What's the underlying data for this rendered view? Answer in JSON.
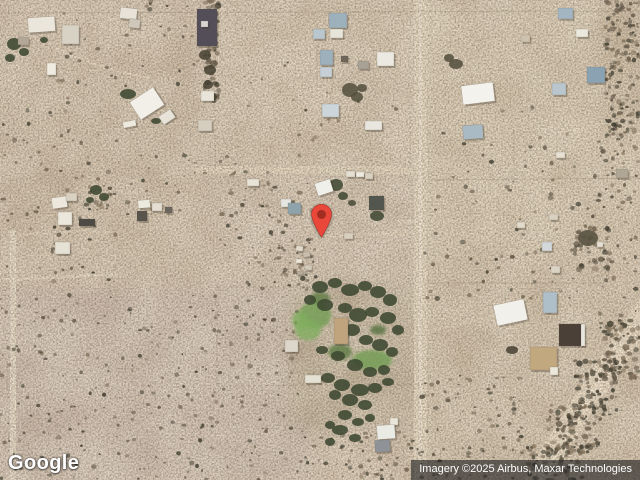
{
  "overlay": {
    "logo_text": "Google",
    "attribution_text": "Imagery ©2025 Airbus, Maxar Technologies"
  },
  "map": {
    "base_color": "#dccbb6",
    "fence_color": "#6b5b45",
    "shadow_color": "#3a3226",
    "building_stroke": "rgba(95,84,66,0.35)",
    "tree_color": "#3d4831",
    "shrub_colors": [
      "#6f6150",
      "#5a5040",
      "#474234",
      "#7d6d57",
      "#3c3a2e"
    ],
    "marker": {
      "x": 321,
      "y": 239,
      "body_color": "#e8473a",
      "dot_color": "#a32c20",
      "outline_color": "rgba(125,28,18,0.55)"
    },
    "patches": [
      {
        "x": 420,
        "y": 0,
        "w": 220,
        "h": 260,
        "fill": "#e5d7bf",
        "op": 0.9
      },
      {
        "x": 215,
        "y": 0,
        "w": 205,
        "h": 168,
        "fill": "#e3d3bd",
        "op": 0.85
      },
      {
        "x": 0,
        "y": 0,
        "w": 212,
        "h": 95,
        "fill": "#dfcfba",
        "op": 0.7
      },
      {
        "x": 25,
        "y": 95,
        "w": 200,
        "h": 190,
        "fill": "#d9c8b2",
        "op": 0.7
      },
      {
        "x": 0,
        "y": 290,
        "w": 310,
        "h": 190,
        "fill": "#d8c8bc",
        "op": 0.9
      },
      {
        "x": 215,
        "y": 168,
        "w": 205,
        "h": 115,
        "fill": "#e1d1be",
        "op": 0.85
      },
      {
        "x": 285,
        "y": 282,
        "w": 135,
        "h": 145,
        "fill": "#c9baa2",
        "op": 0.9
      },
      {
        "x": 420,
        "y": 262,
        "w": 220,
        "h": 218,
        "fill": "#ddcdb6",
        "op": 0.75
      },
      {
        "x": 602,
        "y": 0,
        "w": 38,
        "h": 140,
        "fill": "#cdbba1",
        "op": 0.7
      },
      {
        "x": 455,
        "y": 285,
        "w": 145,
        "h": 55,
        "fill": "#e3d5be",
        "op": 0.6
      }
    ],
    "roads": [
      {
        "kind": "rect",
        "x": 414,
        "y": 0,
        "w": 13,
        "h": 480,
        "fill": "#e8dcc5",
        "op": 1
      },
      {
        "kind": "rect",
        "x": 419,
        "y": 0,
        "w": 3,
        "h": 480,
        "fill": "#f1e8d4",
        "op": 0.8
      },
      {
        "kind": "rect",
        "x": 429,
        "y": 0,
        "w": 3,
        "h": 480,
        "fill": "#e2d5bd",
        "op": 0.5
      },
      {
        "kind": "rect",
        "x": 10,
        "y": 230,
        "w": 6,
        "h": 250,
        "fill": "#eadfca",
        "op": 0.9
      },
      {
        "kind": "rect",
        "x": 195,
        "y": 166,
        "w": 223,
        "h": 8,
        "fill": "#e7dac3",
        "op": 0.85
      },
      {
        "kind": "line",
        "x1": 0,
        "y1": 280,
        "x2": 120,
        "y2": 274,
        "w": 3,
        "fill": "#eadfc9",
        "op": 0.7
      },
      {
        "kind": "line",
        "x1": 318,
        "y1": 236,
        "x2": 414,
        "y2": 233,
        "w": 3,
        "fill": "#e9dcc4",
        "op": 0.6
      },
      {
        "kind": "line",
        "x1": 398,
        "y1": 222,
        "x2": 416,
        "y2": 221,
        "w": 3,
        "fill": "#eadfc8",
        "op": 0.7
      },
      {
        "kind": "line",
        "x1": 428,
        "y1": 331,
        "x2": 494,
        "y2": 316,
        "w": 3,
        "fill": "#e9dcc4",
        "op": 0.5
      },
      {
        "kind": "path",
        "d": "M648,308 C618,352 588,398 566,432 C552,454 542,468 536,482",
        "w": 24,
        "fill": "#ecdfc8",
        "op": 0.9
      },
      {
        "kind": "path",
        "d": "M645,315 C615,358 590,398 568,432 C554,454 545,466 539,480",
        "w": 8,
        "fill": "#f1e5cf",
        "op": 0.8
      },
      {
        "kind": "path",
        "d": "M55,48 C85,62 115,72 150,78",
        "w": 2.5,
        "fill": "#ecdfca",
        "op": 0.6
      },
      {
        "kind": "path",
        "d": "M16,236 C40,232 80,230 110,232",
        "w": 2.5,
        "fill": "#e9dcc6",
        "op": 0.5
      }
    ],
    "fences": [
      [
        0,
        13,
        640,
        11,
        0.18,
        null
      ],
      [
        215,
        0,
        215,
        170,
        0.25,
        "2 3"
      ],
      [
        217,
        287,
        320,
        287,
        0.3,
        "3 3"
      ],
      [
        217,
        287,
        217,
        387,
        0.3,
        "3 3"
      ],
      [
        217,
        386,
        430,
        384,
        0.28,
        "3 3"
      ],
      [
        430,
        180,
        640,
        178,
        0.2,
        null
      ],
      [
        514,
        130,
        514,
        180,
        0.15,
        null
      ],
      [
        427,
        283,
        604,
        283,
        0.2,
        null
      ],
      [
        318,
        177,
        373,
        176,
        0.3,
        "2 2"
      ],
      [
        317,
        45,
        317,
        80,
        0.25,
        null
      ],
      [
        410,
        62,
        410,
        168,
        0.2,
        "2 3"
      ]
    ],
    "shrub_regions": [
      {
        "x": 0,
        "y": 295,
        "w": 300,
        "h": 185,
        "count": 260
      },
      {
        "x": 0,
        "y": 95,
        "w": 120,
        "h": 200,
        "count": 70
      },
      {
        "x": 55,
        "y": 0,
        "w": 160,
        "h": 90,
        "count": 45
      },
      {
        "x": 215,
        "y": 180,
        "w": 100,
        "h": 110,
        "count": 50
      },
      {
        "x": 605,
        "y": 0,
        "w": 35,
        "h": 140,
        "count": 150,
        "rmin": 1,
        "rmax": 2.6
      },
      {
        "x": 595,
        "y": 140,
        "w": 45,
        "h": 180,
        "count": 60
      },
      {
        "x": 600,
        "y": 320,
        "w": 40,
        "h": 60,
        "count": 80,
        "rmin": 1,
        "rmax": 2.8
      },
      {
        "x": 575,
        "y": 360,
        "w": 45,
        "h": 60,
        "count": 90,
        "rmin": 1,
        "rmax": 2.8
      },
      {
        "x": 548,
        "y": 405,
        "w": 50,
        "h": 50,
        "count": 90,
        "rmin": 1,
        "rmax": 2.8
      },
      {
        "x": 528,
        "y": 445,
        "w": 55,
        "h": 35,
        "count": 70,
        "rmin": 1,
        "rmax": 2.6
      },
      {
        "x": 420,
        "y": 375,
        "w": 110,
        "h": 105,
        "count": 90
      },
      {
        "x": 230,
        "y": 55,
        "w": 175,
        "h": 105,
        "count": 25
      },
      {
        "x": 435,
        "y": 105,
        "w": 160,
        "h": 130,
        "count": 45
      },
      {
        "x": 125,
        "y": 150,
        "w": 150,
        "h": 70,
        "count": 40
      },
      {
        "x": 300,
        "y": 430,
        "w": 120,
        "h": 50,
        "count": 60
      },
      {
        "x": 205,
        "y": 0,
        "w": 14,
        "h": 105,
        "count": 45,
        "rmin": 1.5,
        "rmax": 3.2
      },
      {
        "x": 85,
        "y": 185,
        "w": 30,
        "h": 25,
        "count": 18
      },
      {
        "x": 270,
        "y": 240,
        "w": 50,
        "h": 45,
        "count": 30
      },
      {
        "x": 420,
        "y": 240,
        "w": 180,
        "h": 60,
        "count": 40
      },
      {
        "x": 575,
        "y": 225,
        "w": 35,
        "h": 45,
        "count": 35,
        "rmin": 1.2,
        "rmax": 3
      }
    ],
    "lawns": [
      [
        315,
        315,
        16,
        14,
        "#6f9c52"
      ],
      [
        308,
        330,
        13,
        10,
        "#7fae5e"
      ],
      [
        300,
        320,
        8,
        9,
        "#7fae5e"
      ],
      [
        372,
        360,
        20,
        10,
        "#6f9c52"
      ],
      [
        340,
        352,
        12,
        8,
        "#5c7a42"
      ],
      [
        320,
        298,
        10,
        6,
        "#5c7a42"
      ],
      [
        378,
        330,
        8,
        5,
        "#55703f"
      ]
    ],
    "trees": [
      [
        14,
        44,
        7,
        6
      ],
      [
        24,
        52,
        5,
        4
      ],
      [
        10,
        58,
        5,
        4
      ],
      [
        44,
        40,
        4,
        3
      ],
      [
        96,
        190,
        6,
        5
      ],
      [
        104,
        197,
        5,
        4
      ],
      [
        90,
        200,
        4,
        3
      ],
      [
        128,
        94,
        8,
        5
      ],
      [
        147,
        103,
        6,
        4
      ],
      [
        156,
        121,
        5,
        3
      ],
      [
        336,
        185,
        7,
        6,
        "#414a36"
      ],
      [
        343,
        196,
        5,
        4,
        "#414a36"
      ],
      [
        352,
        203,
        4,
        3,
        "#4a4a38"
      ],
      [
        377,
        216,
        7,
        5,
        "#414a36"
      ],
      [
        350,
        90,
        8,
        7,
        "#55513f"
      ],
      [
        357,
        97,
        6,
        5,
        "#55513f"
      ],
      [
        362,
        88,
        5,
        4,
        "#55513f"
      ],
      [
        456,
        64,
        7,
        5,
        "#55513f"
      ],
      [
        449,
        58,
        5,
        4,
        "#55513f"
      ],
      [
        320,
        287,
        8,
        6
      ],
      [
        335,
        283,
        7,
        5
      ],
      [
        350,
        290,
        9,
        6
      ],
      [
        365,
        286,
        7,
        5
      ],
      [
        378,
        292,
        8,
        6
      ],
      [
        390,
        300,
        7,
        6
      ],
      [
        310,
        300,
        6,
        5
      ],
      [
        325,
        305,
        8,
        6
      ],
      [
        345,
        308,
        7,
        5
      ],
      [
        358,
        315,
        9,
        7
      ],
      [
        372,
        312,
        7,
        5
      ],
      [
        388,
        318,
        8,
        6
      ],
      [
        398,
        330,
        6,
        5
      ],
      [
        352,
        330,
        8,
        6
      ],
      [
        366,
        340,
        7,
        5
      ],
      [
        380,
        345,
        8,
        6
      ],
      [
        392,
        352,
        6,
        5
      ],
      [
        322,
        350,
        6,
        4
      ],
      [
        338,
        356,
        7,
        5
      ],
      [
        355,
        365,
        8,
        6
      ],
      [
        370,
        372,
        7,
        5
      ],
      [
        384,
        370,
        6,
        5
      ],
      [
        328,
        378,
        7,
        5
      ],
      [
        342,
        385,
        8,
        6
      ],
      [
        360,
        390,
        9,
        6
      ],
      [
        375,
        388,
        7,
        5
      ],
      [
        388,
        382,
        6,
        4
      ],
      [
        350,
        400,
        8,
        6
      ],
      [
        365,
        405,
        7,
        5
      ],
      [
        335,
        395,
        6,
        5
      ],
      [
        345,
        415,
        7,
        5
      ],
      [
        358,
        422,
        6,
        4
      ],
      [
        330,
        425,
        5,
        4
      ],
      [
        370,
        418,
        5,
        4
      ],
      [
        340,
        430,
        8,
        5
      ],
      [
        355,
        438,
        6,
        4
      ],
      [
        330,
        442,
        5,
        4
      ],
      [
        512,
        350,
        6,
        4,
        "#4a4436"
      ],
      [
        588,
        238,
        10,
        8,
        "#55503f"
      ],
      [
        205,
        55,
        6,
        5,
        "#4a4436"
      ],
      [
        210,
        70,
        6,
        5,
        "#4a4436"
      ],
      [
        208,
        85,
        5,
        4,
        "#4a4436"
      ],
      [
        212,
        97,
        5,
        4,
        "#4a4436"
      ]
    ],
    "buildings": [
      [
        28,
        17,
        27,
        15,
        -4,
        "#ebe6dc"
      ],
      [
        62,
        25,
        17,
        19,
        0,
        "#d8d2c5"
      ],
      [
        18,
        37,
        11,
        8,
        2,
        "#b3a798"
      ],
      [
        47,
        63,
        9,
        12,
        0,
        "#efebe1"
      ],
      [
        120,
        8,
        17,
        11,
        6,
        "#e8e3d9"
      ],
      [
        129,
        19,
        11,
        9,
        6,
        "#cfc8ba"
      ],
      [
        197,
        9,
        20,
        37,
        0,
        "#544e58"
      ],
      [
        201,
        21,
        7,
        6,
        0,
        "#d8d4cf"
      ],
      [
        201,
        91,
        13,
        10,
        0,
        "#e9e4d9"
      ],
      [
        198,
        120,
        14,
        11,
        0,
        "#d5cebf"
      ],
      [
        133,
        93,
        28,
        21,
        -33,
        "#f2efe8"
      ],
      [
        160,
        112,
        14,
        10,
        -33,
        "#e7e3d9"
      ],
      [
        123,
        121,
        13,
        6,
        -12,
        "#eee9de"
      ],
      [
        52,
        197,
        15,
        11,
        -8,
        "#ece8dd"
      ],
      [
        66,
        193,
        11,
        8,
        0,
        "#d8d1c2"
      ],
      [
        58,
        212,
        14,
        13,
        0,
        "#ebe7dd"
      ],
      [
        79,
        219,
        16,
        7,
        0,
        "#4e4a45"
      ],
      [
        55,
        242,
        15,
        12,
        0,
        "#e6e1d5"
      ],
      [
        138,
        200,
        12,
        8,
        -5,
        "#eceadf"
      ],
      [
        152,
        203,
        10,
        8,
        0,
        "#e3ded1"
      ],
      [
        137,
        211,
        10,
        10,
        0,
        "#57544d"
      ],
      [
        165,
        207,
        7,
        6,
        0,
        "#6b675f"
      ],
      [
        247,
        179,
        12,
        7,
        0,
        "#e8e3d7"
      ],
      [
        281,
        199,
        10,
        8,
        0,
        "#e5e6e2"
      ],
      [
        288,
        203,
        13,
        11,
        0,
        "#8fa3ad"
      ],
      [
        316,
        181,
        16,
        13,
        -18,
        "#eff0ea"
      ],
      [
        346,
        171,
        9,
        6,
        0,
        "#e4dfd1"
      ],
      [
        356,
        172,
        8,
        5,
        0,
        "#eeebe1"
      ],
      [
        365,
        173,
        8,
        6,
        0,
        "#d8d1c1"
      ],
      [
        369,
        196,
        15,
        14,
        0,
        "#53564e"
      ],
      [
        344,
        233,
        9,
        6,
        0,
        "#d8cfbe"
      ],
      [
        296,
        246,
        7,
        5,
        10,
        "#e2dbcc"
      ],
      [
        303,
        252,
        7,
        5,
        -8,
        "#c7bead"
      ],
      [
        296,
        259,
        6,
        4,
        0,
        "#eee8db"
      ],
      [
        305,
        265,
        7,
        5,
        6,
        "#d3caba"
      ],
      [
        297,
        271,
        6,
        4,
        -5,
        "#b7ac9a"
      ],
      [
        329,
        13,
        18,
        15,
        0,
        "#9db1bd"
      ],
      [
        313,
        29,
        12,
        10,
        0,
        "#b9c6cd"
      ],
      [
        330,
        29,
        13,
        9,
        0,
        "#e7e4da"
      ],
      [
        320,
        50,
        13,
        15,
        0,
        "#9db1bd"
      ],
      [
        320,
        67,
        12,
        10,
        0,
        "#c5cfd5"
      ],
      [
        377,
        52,
        17,
        14,
        0,
        "#ebe9e1"
      ],
      [
        358,
        61,
        11,
        8,
        0,
        "#a8a196"
      ],
      [
        341,
        56,
        7,
        6,
        0,
        "#6e6659"
      ],
      [
        322,
        104,
        17,
        13,
        0,
        "#ccd6da"
      ],
      [
        365,
        121,
        17,
        9,
        0,
        "#e8e6de"
      ],
      [
        462,
        84,
        32,
        19,
        -7,
        "#f4f2ec"
      ],
      [
        463,
        125,
        20,
        14,
        -4,
        "#a9bac4"
      ],
      [
        558,
        8,
        15,
        11,
        0,
        "#a2b5c1"
      ],
      [
        576,
        29,
        12,
        8,
        0,
        "#ebe9de"
      ],
      [
        587,
        67,
        18,
        16,
        0,
        "#8ba2b2"
      ],
      [
        552,
        83,
        14,
        12,
        0,
        "#bac6cd"
      ],
      [
        521,
        35,
        9,
        7,
        0,
        "#cdc2ae"
      ],
      [
        556,
        152,
        9,
        6,
        0,
        "#e7e1d3"
      ],
      [
        616,
        169,
        12,
        9,
        0,
        "#b0a696"
      ],
      [
        549,
        214,
        9,
        6,
        0,
        "#d8d1c1"
      ],
      [
        517,
        222,
        8,
        6,
        0,
        "#e2dbcc"
      ],
      [
        542,
        242,
        10,
        9,
        0,
        "#d3d8da"
      ],
      [
        551,
        266,
        9,
        7,
        0,
        "#dbd3c3"
      ],
      [
        597,
        242,
        6,
        5,
        0,
        "#e6e1d4"
      ],
      [
        543,
        292,
        14,
        21,
        0,
        "#aebfca"
      ],
      [
        495,
        302,
        31,
        21,
        -12,
        "#f2f0ea"
      ],
      [
        559,
        324,
        24,
        22,
        0,
        "#4a4038"
      ],
      [
        581,
        324,
        4,
        22,
        0,
        "#e8e6de"
      ],
      [
        530,
        347,
        27,
        23,
        0,
        "#c2a87f"
      ],
      [
        550,
        367,
        8,
        8,
        0,
        "#ebe7db"
      ],
      [
        334,
        318,
        14,
        26,
        0,
        "#bfa47e"
      ],
      [
        285,
        340,
        13,
        12,
        0,
        "#dcd7ca"
      ],
      [
        305,
        375,
        16,
        8,
        0,
        "#e4e0d3"
      ],
      [
        390,
        418,
        8,
        7,
        0,
        "#e9e5d9"
      ],
      [
        377,
        425,
        18,
        14,
        -4,
        "#eaebe5"
      ],
      [
        375,
        440,
        15,
        12,
        -4,
        "#8f9397"
      ]
    ]
  }
}
